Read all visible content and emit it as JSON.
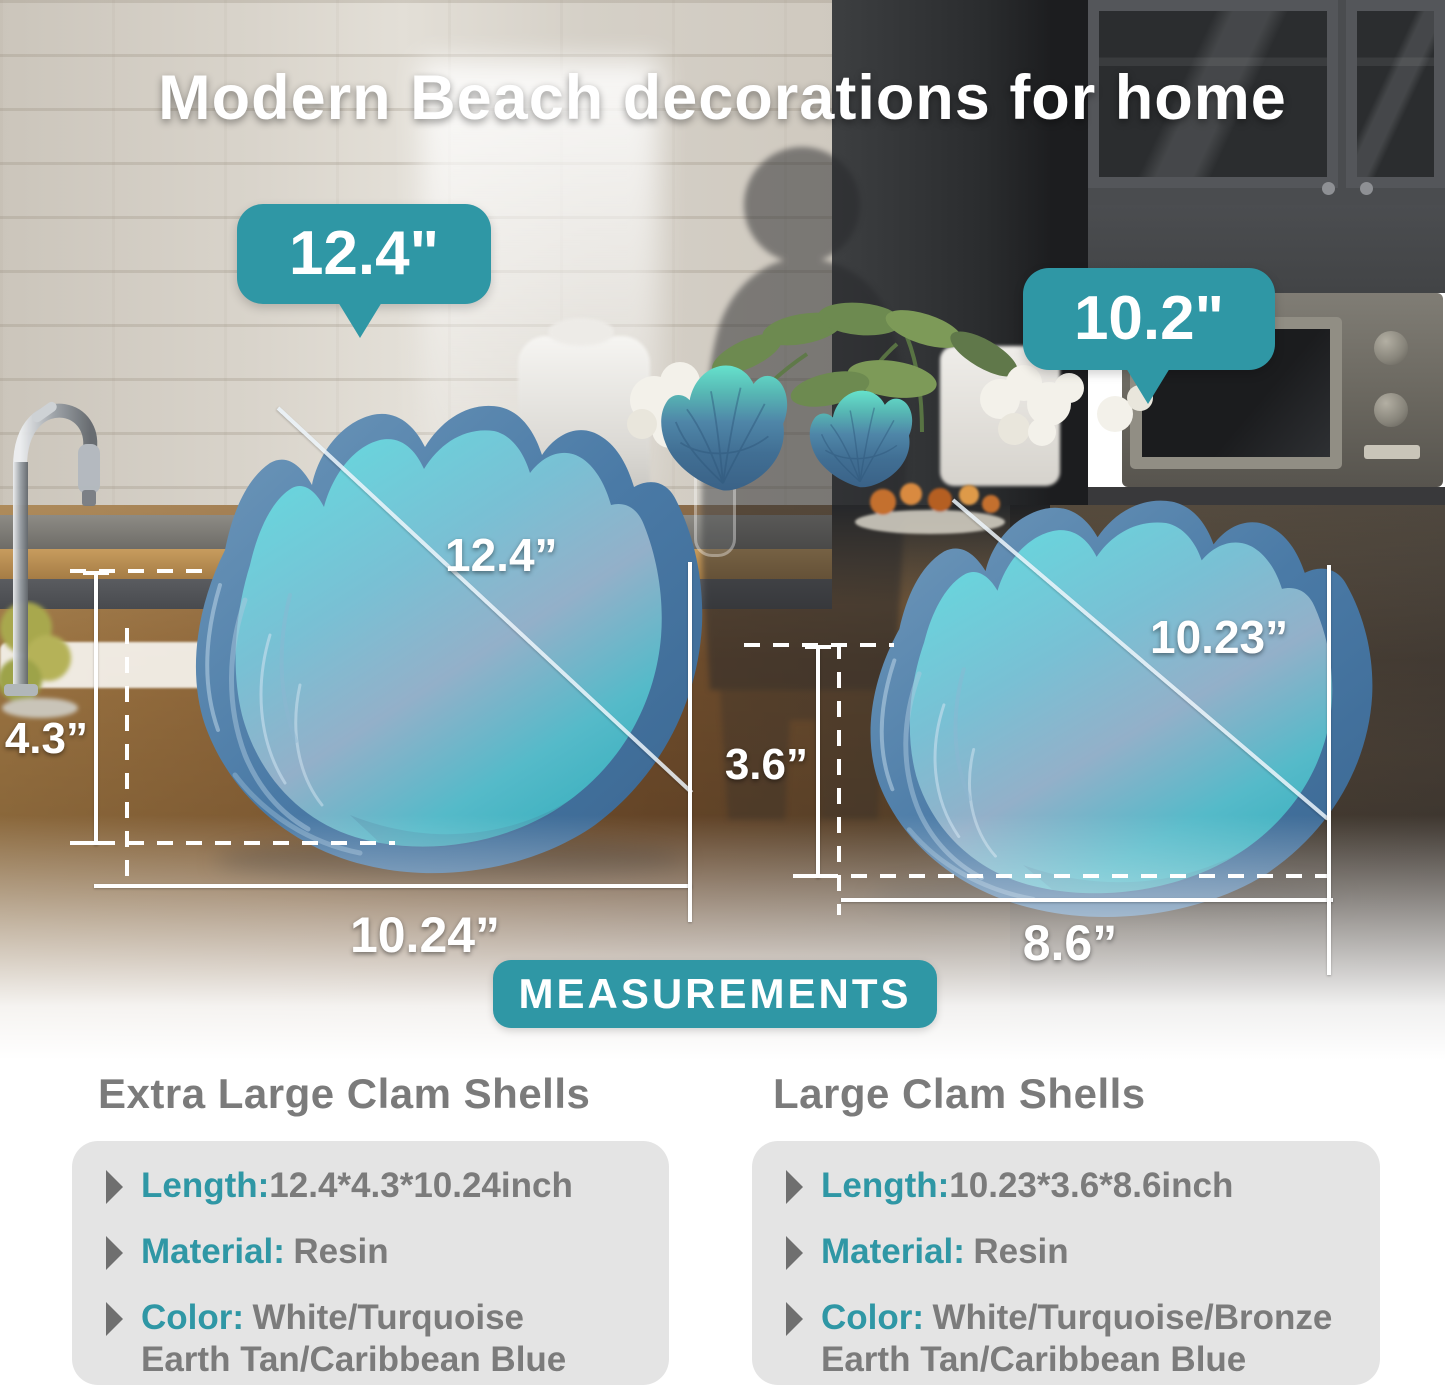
{
  "colors": {
    "accent_teal": "#2f97a5",
    "heading_gray": "#7b7b7b",
    "value_gray": "#7b7b7b",
    "card_bg": "#e4e4e4",
    "bullet_gray": "#6f6f6f",
    "measure_white": "#ffffff"
  },
  "title": "Modern Beach decorations for home",
  "callouts": {
    "left": "12.4\"",
    "right": "10.2\""
  },
  "measurements": {
    "left_shell": {
      "diagonal": "12.4”",
      "height": "4.3”",
      "width": "10.24”"
    },
    "right_shell": {
      "diagonal": "10.23”",
      "height": "3.6”",
      "width": "8.6”"
    }
  },
  "banner": "MEASUREMENTS",
  "products": [
    {
      "heading": "Extra Large Clam Shells",
      "specs": [
        {
          "label": "Length:",
          "value": "12.4*4.3*10.24inch",
          "value2": ""
        },
        {
          "label": "Material:",
          "value": "Resin",
          "value2": ""
        },
        {
          "label": "Color:",
          "value": "White/Turquoise",
          "value2": "Earth Tan/Caribbean Blue"
        }
      ]
    },
    {
      "heading": "Large Clam Shells",
      "specs": [
        {
          "label": "Length:",
          "value": "10.23*3.6*8.6inch",
          "value2": ""
        },
        {
          "label": "Material:",
          "value": "Resin",
          "value2": ""
        },
        {
          "label": "Color:",
          "value": "White/Turquoise/Bronze",
          "value2": "Earth Tan/Caribbean Blue"
        }
      ]
    }
  ]
}
